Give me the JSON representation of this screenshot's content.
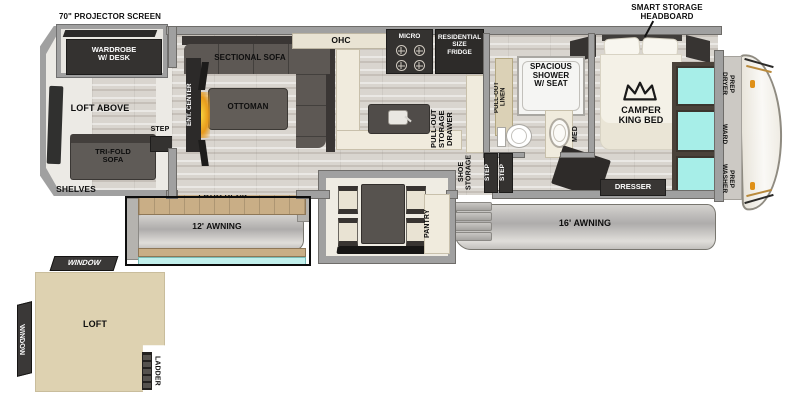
{
  "plan": {
    "rear": {
      "projector_screen": "70\" PROJECTOR SCREEN",
      "wardrobe": "WARDROBE\nW/ DESK",
      "loft_above": "LOFT ABOVE",
      "tri_fold_sofa": "TRI-FOLD\nSOFA",
      "step": "STEP",
      "shelves": "SHELVES"
    },
    "living": {
      "ent_center": "ENT. CENTER",
      "sectional_sofa": "SECTIONAL SOFA",
      "ottoman": "OTTOMAN"
    },
    "kitchen": {
      "ohc": "OHC",
      "micro": "MICRO",
      "fridge": "RESIDENTIAL\nSIZE\nFRIDGE",
      "pull_out_storage_drawer": "PULL-OUT\nSTORAGE\nDRAWER",
      "pantry": "PANTRY"
    },
    "entry": {
      "shoe_storage": "SHOE\nSTORAGE",
      "step_1": "STEP",
      "step_2": "STEP"
    },
    "patio": {
      "deck": "PATIO DECK",
      "awning_12": "12' AWNING"
    },
    "awning_16": "16' AWNING",
    "bath": {
      "pull_out_linen": "PULL-OUT\nLINEN",
      "shower": "SPACIOUS\nSHOWER\nW/ SEAT",
      "med": "MED"
    },
    "bedroom": {
      "headboard": "SMART STORAGE\nHEADBOARD",
      "bed": "CAMPER\nKING BED",
      "dresser": "DRESSER"
    },
    "front_closet": {
      "dryer_prep": "DRYER\nPREP",
      "ward": "WARD",
      "washer_prep": "WASHER\nPREP"
    },
    "loft_diagram": {
      "window_top": "WINDOW",
      "window_left": "WINDOW",
      "room": "LOFT",
      "ladder": "LADDER"
    }
  },
  "colors": {
    "wall_gray": "#a0a0a0",
    "dark_furniture": "#343230",
    "teal_glass": "#a7eee8",
    "deck_wood": "#c9ae86",
    "loft_beige": "#ded2b1",
    "awning_gray": "#b2b0ad",
    "cap_accent_orange": "#df9018"
  }
}
